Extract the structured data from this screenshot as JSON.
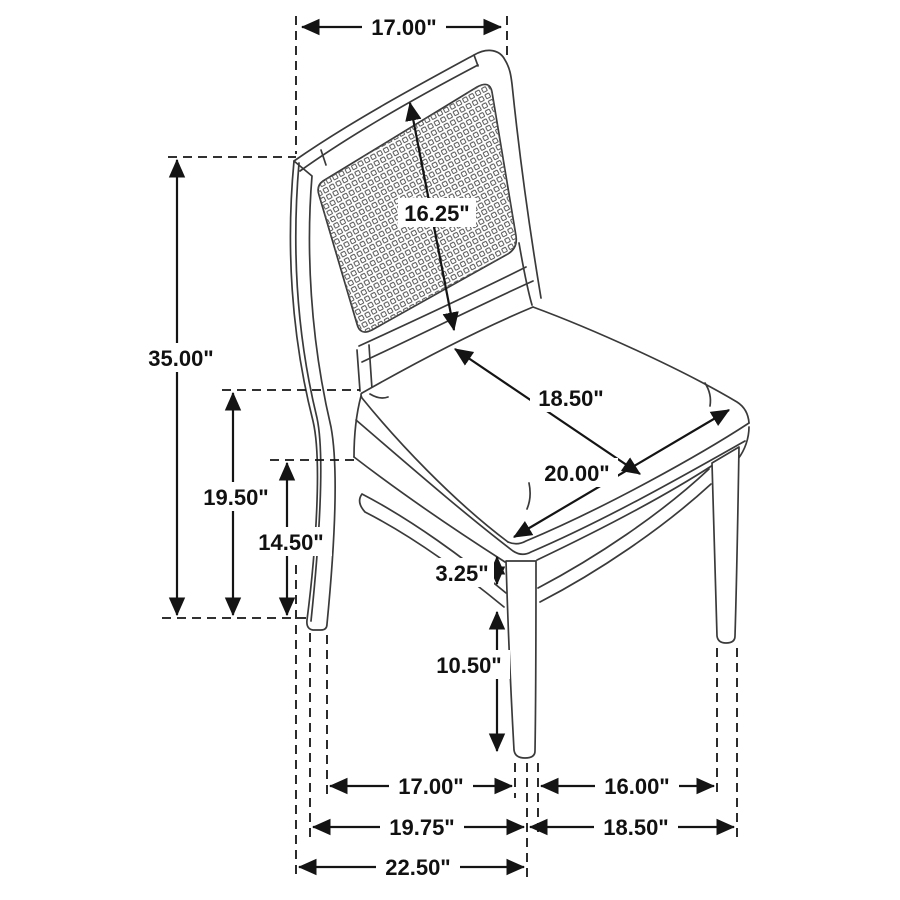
{
  "page": {
    "type": "product-dimension-diagram",
    "subject": "cane-back dining side chair line drawing with dimension callouts",
    "unit": "inches",
    "background_color": "#ffffff",
    "line_color": "#141414",
    "chair_line_color": "#3a3a3a"
  },
  "dims": {
    "back_top_width": {
      "label": "17.00\"",
      "meaning": "width across top of chair back"
    },
    "back_panel_diagonal": {
      "label": "16.25\"",
      "meaning": "cane back panel height (diagonal callout)"
    },
    "overall_height": {
      "label": "35.00\"",
      "meaning": "overall chair height, floor to top of back"
    },
    "seat_height": {
      "label": "19.50\"",
      "meaning": "floor to top of seat"
    },
    "apron_height": {
      "label": "14.50\"",
      "meaning": "floor to bottom of seat apron"
    },
    "seat_depth": {
      "label": "18.50\"",
      "meaning": "seat depth, back edge to front edge"
    },
    "seat_width": {
      "label": "20.00\"",
      "meaning": "seat width across front edge"
    },
    "apron_stretcher_gap": {
      "label": "3.25\"",
      "meaning": "gap between apron and stretcher"
    },
    "stretcher_floor": {
      "label": "10.50\"",
      "meaning": "floor to bottom of stretcher"
    },
    "feet_span_side_inner": {
      "label": "17.00\"",
      "meaning": "inside span between back and front feet (side)"
    },
    "feet_span_front_inner": {
      "label": "16.00\"",
      "meaning": "inside span between front feet"
    },
    "depth_mid_span": {
      "label": "19.75\"",
      "meaning": "back foot to front leg centerline"
    },
    "front_outer_span": {
      "label": "18.50\"",
      "meaning": "front leg centerline to outer front-right foot"
    },
    "overall_depth": {
      "label": "22.50\"",
      "meaning": "overall depth, chair back to front leg centerline"
    }
  }
}
